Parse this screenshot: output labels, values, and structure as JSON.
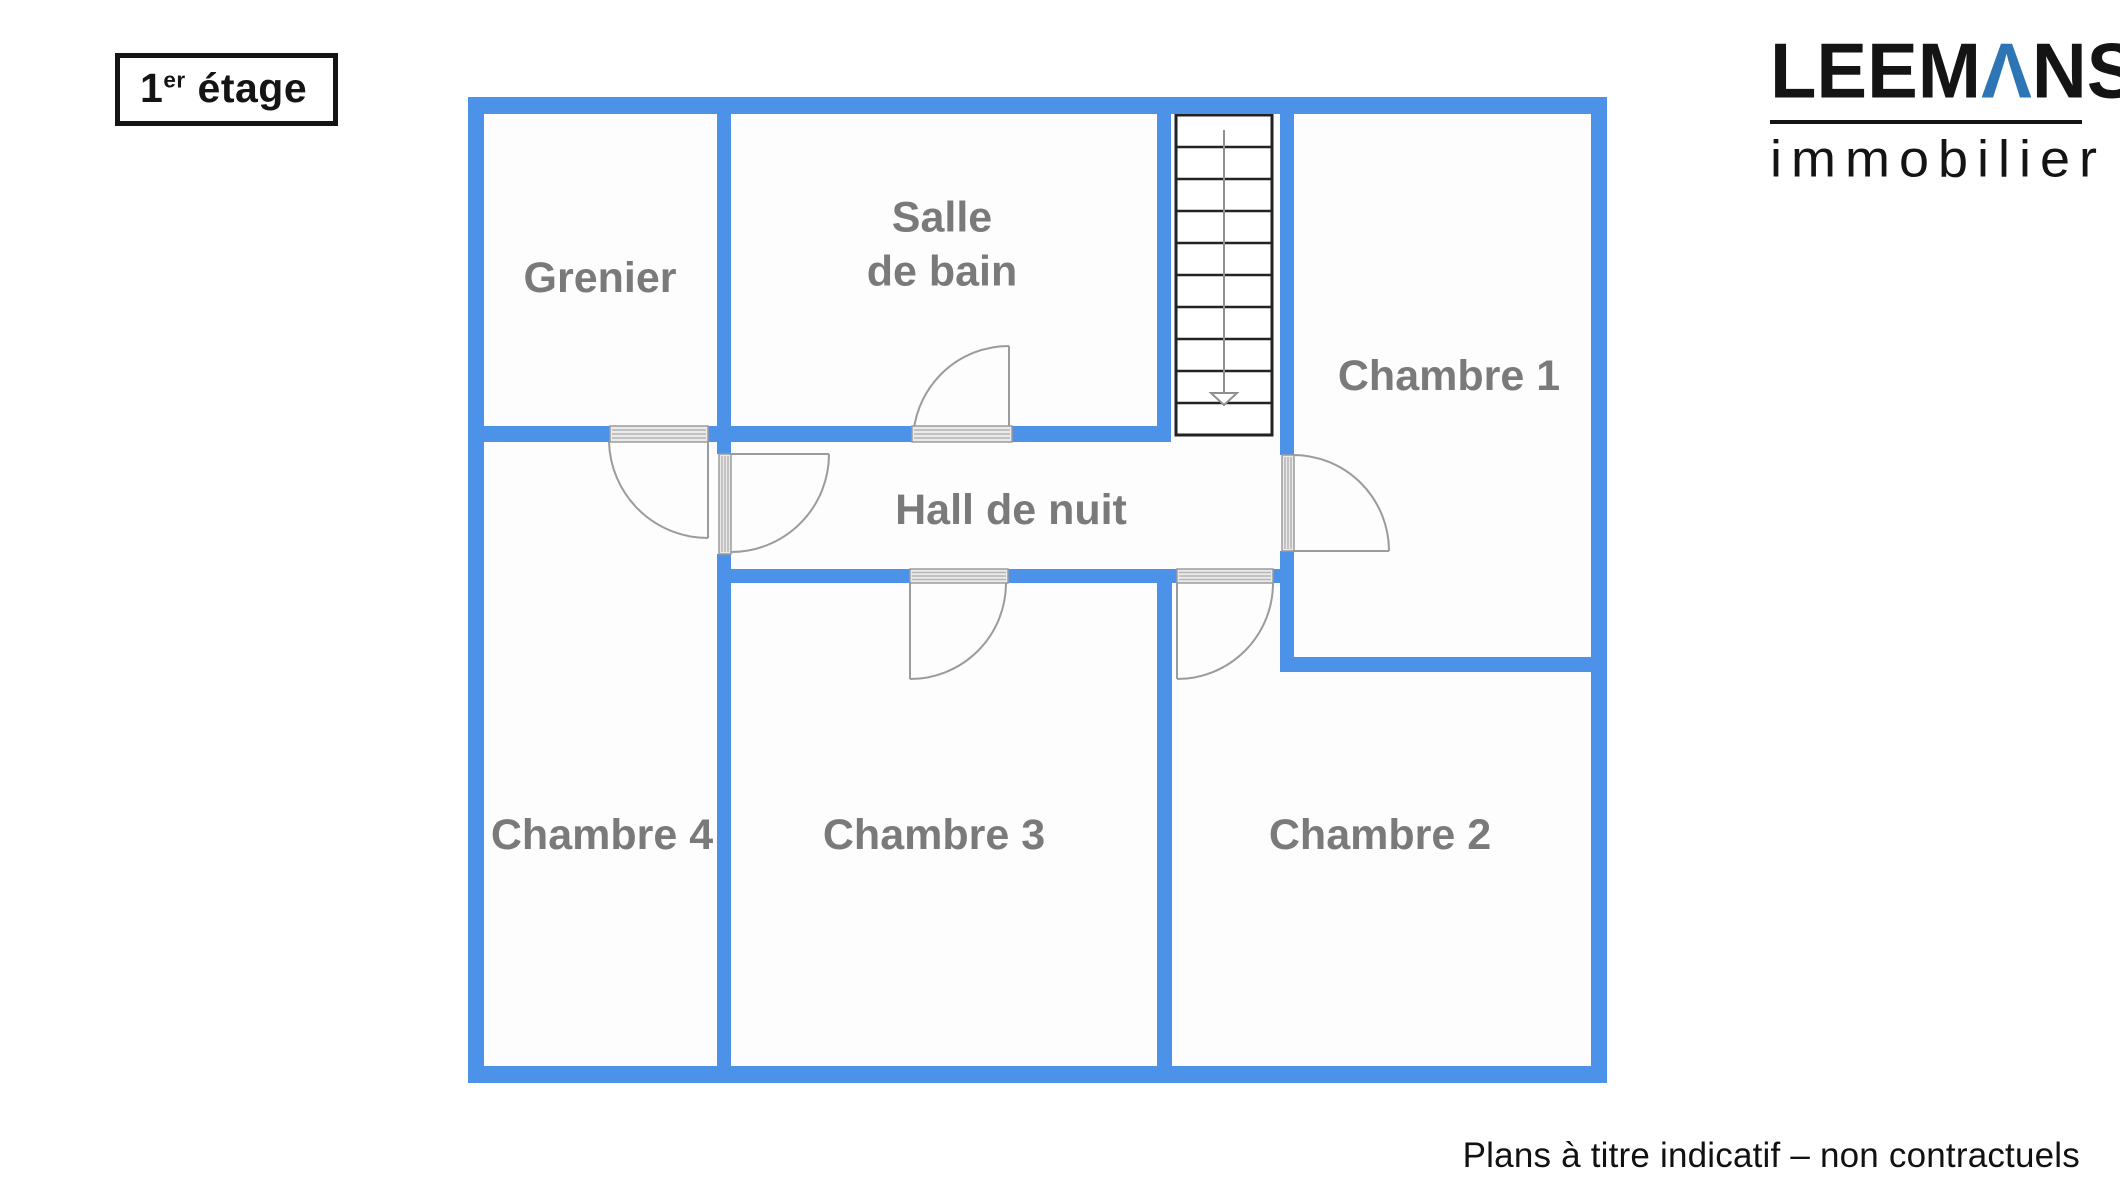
{
  "page": {
    "width": 2120,
    "height": 1200,
    "background": "#ffffff"
  },
  "title_badge": {
    "number": "1",
    "superscript": "er",
    "word": "étage"
  },
  "logo": {
    "part1": "LEEM",
    "a_char": "Λ",
    "part2": "NS",
    "subtitle": "immobilier",
    "accent_color": "#2e75b5",
    "text_color": "#141414"
  },
  "footer": {
    "text": "Plans à titre indicatif – non contractuels"
  },
  "floorplan": {
    "wall_color": "#4b92e8",
    "room_fill": "#fdfdfd",
    "door_stroke": "#9b9b9b",
    "threshold_fill": "#eaeaea",
    "threshold_line": "#b5b5b5",
    "threshold_border": "#9b9b9b",
    "stairs_stroke": "#222222",
    "stairs_guide": "#8f8f8f",
    "bg_rect": [
      468,
      97,
      1139,
      986
    ],
    "rooms": [
      {
        "id": "grenier",
        "label": "Grenier",
        "x": 600,
        "y": 279
      },
      {
        "id": "salle-de-bain",
        "label": "Salle\nde bain",
        "x": 942,
        "y": 245
      },
      {
        "id": "chambre-1",
        "label": "Chambre 1",
        "x": 1449,
        "y": 377
      },
      {
        "id": "hall-de-nuit",
        "label": "Hall de nuit",
        "x": 1011,
        "y": 511
      },
      {
        "id": "chambre-4",
        "label": "Chambre 4",
        "x": 602,
        "y": 836
      },
      {
        "id": "chambre-3",
        "label": "Chambre 3",
        "x": 934,
        "y": 836
      },
      {
        "id": "chambre-2",
        "label": "Chambre 2",
        "x": 1380,
        "y": 836
      }
    ],
    "walls": [
      {
        "name": "outer-top",
        "rect": [
          468,
          97,
          1139,
          17
        ]
      },
      {
        "name": "outer-left",
        "rect": [
          468,
          97,
          16,
          986
        ]
      },
      {
        "name": "outer-bottom",
        "rect": [
          468,
          1066,
          1139,
          17
        ]
      },
      {
        "name": "outer-right",
        "rect": [
          1591,
          97,
          16,
          986
        ]
      },
      {
        "name": "grenier-sdb-divider",
        "rect": [
          717,
          114,
          14,
          312
        ]
      },
      {
        "name": "hall-top-left",
        "rect": [
          484,
          426,
          126,
          16
        ]
      },
      {
        "name": "hall-top-mid",
        "rect": [
          708,
          426,
          204,
          16
        ]
      },
      {
        "name": "hall-top-right",
        "rect": [
          1012,
          426,
          145,
          16
        ]
      },
      {
        "name": "sdb-stairs-divider",
        "rect": [
          1157,
          114,
          14,
          328
        ]
      },
      {
        "name": "ch4-ch3-stub",
        "rect": [
          717,
          442,
          14,
          12
        ]
      },
      {
        "name": "ch4-ch3-lower",
        "rect": [
          717,
          554,
          14,
          512
        ]
      },
      {
        "name": "hall-bottom-left",
        "rect": [
          731,
          569,
          179,
          14
        ]
      },
      {
        "name": "hall-bottom-mid",
        "rect": [
          1008,
          569,
          169,
          14
        ]
      },
      {
        "name": "hall-bottom-right",
        "rect": [
          1273,
          569,
          21,
          14
        ]
      },
      {
        "name": "ch1-left-upper",
        "rect": [
          1280,
          114,
          14,
          341
        ]
      },
      {
        "name": "ch1-left-lower",
        "rect": [
          1280,
          551,
          14,
          121
        ]
      },
      {
        "name": "ch1-ch2-divider",
        "rect": [
          1280,
          657,
          327,
          15
        ]
      },
      {
        "name": "ch3-ch2-divider",
        "rect": [
          1157,
          583,
          15,
          483
        ]
      }
    ],
    "thresholds": [
      {
        "name": "grenier-door-threshold",
        "rect": [
          610,
          426,
          98,
          16
        ],
        "dir": "h"
      },
      {
        "name": "sdb-door-threshold",
        "rect": [
          912,
          426,
          100,
          16
        ],
        "dir": "h"
      },
      {
        "name": "chambre4-door-threshold",
        "rect": [
          719,
          454,
          12,
          100
        ],
        "dir": "v"
      },
      {
        "name": "chambre1-door-threshold",
        "rect": [
          1282,
          455,
          12,
          96
        ],
        "dir": "v"
      },
      {
        "name": "chambre3-door-threshold",
        "rect": [
          910,
          569,
          98,
          14
        ],
        "dir": "h"
      },
      {
        "name": "chambre2-door-threshold",
        "rect": [
          1177,
          569,
          96,
          14
        ],
        "dir": "h"
      }
    ],
    "doors": [
      {
        "name": "grenier-door",
        "path": "M708 442 L708 538 M609 442 A99 99 0 0 0 708 538"
      },
      {
        "name": "chambre4-door",
        "path": "M731 454 L829 454 M829 454 A98 98 0 0 1 731 552"
      },
      {
        "name": "sdb-door",
        "path": "M1009 442 L1009 346 M1009 346 A96 96 0 0 0 913 442"
      },
      {
        "name": "chambre1-door",
        "path": "M1293 551 L1389 551 M1389 551 A96 96 0 0 0 1293 455"
      },
      {
        "name": "chambre3-door",
        "path": "M910 583 L910 679 M910 679 A96 96 0 0 0 1006 583"
      },
      {
        "name": "chambre2-door",
        "path": "M1177 583 L1177 679 M1177 679 A96 96 0 0 0 1273 583"
      }
    ],
    "stairs": {
      "x": 1176,
      "y": 115,
      "w": 96,
      "h": 320,
      "steps": 10,
      "direction": "down"
    }
  }
}
